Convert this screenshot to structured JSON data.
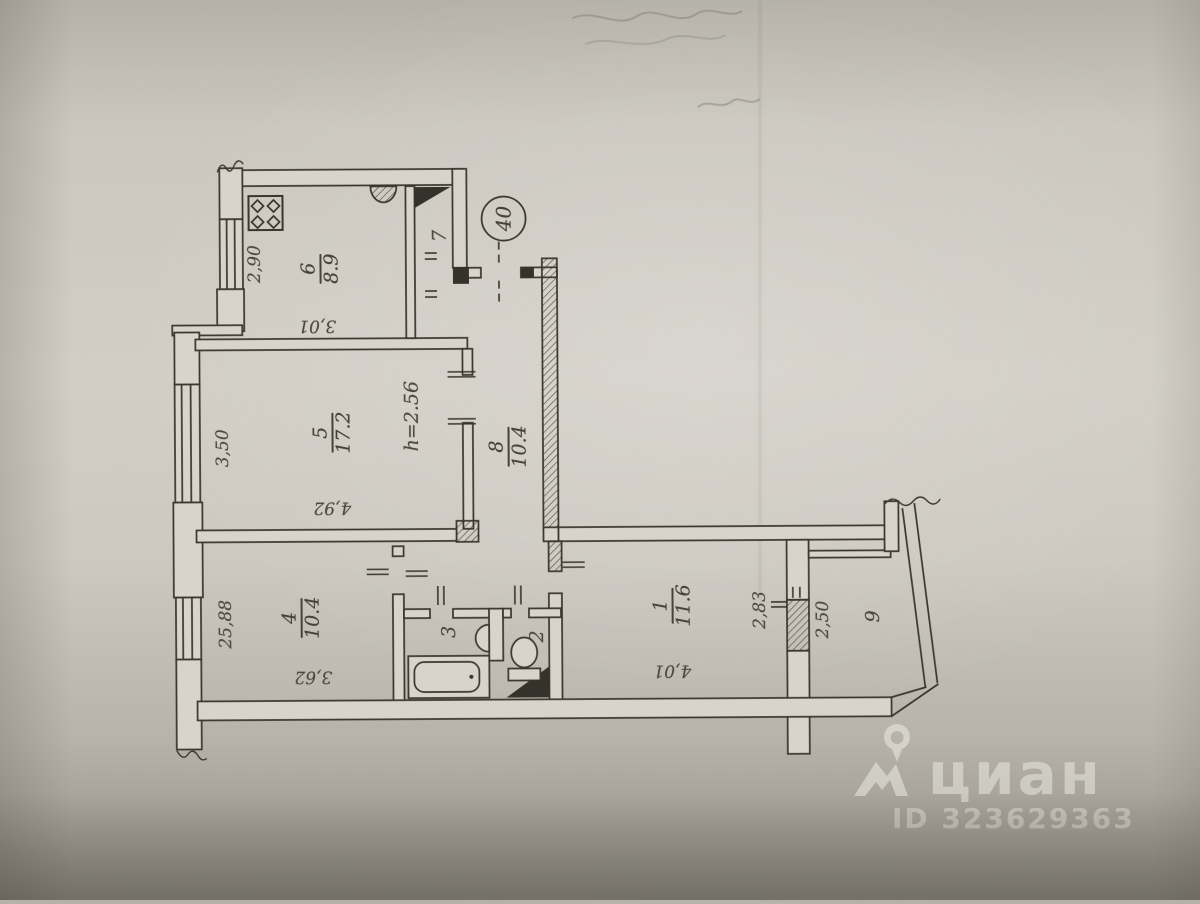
{
  "scan": {
    "paper_color": "#cdc9c1",
    "ink_color": "#3a362e"
  },
  "apartment": {
    "number": "40"
  },
  "rooms": {
    "r1": {
      "num": "1",
      "area": "11.6"
    },
    "r2": {
      "num": "2"
    },
    "r3": {
      "num": "3"
    },
    "r4": {
      "num": "4",
      "area": "10.4"
    },
    "r5": {
      "num": "5",
      "area": "17.2"
    },
    "r6": {
      "num": "6",
      "area": "8.9"
    },
    "r7": {
      "num": "7"
    },
    "r8": {
      "num": "8",
      "area": "10.4"
    },
    "r9": {
      "num": "9"
    }
  },
  "dims": {
    "kitchen_width": "2,90",
    "kitchen_length": "3,01",
    "room5_width": "3,50",
    "room5_length": "4,92",
    "ceiling_height": "h=2.56",
    "left_total": "25,88",
    "room4_length": "3,62",
    "room1_length": "4,01",
    "room1_width": "2,83",
    "balcony_width": "2,50"
  },
  "watermark": {
    "brand": "циан",
    "id_label": "ID 323629363"
  }
}
